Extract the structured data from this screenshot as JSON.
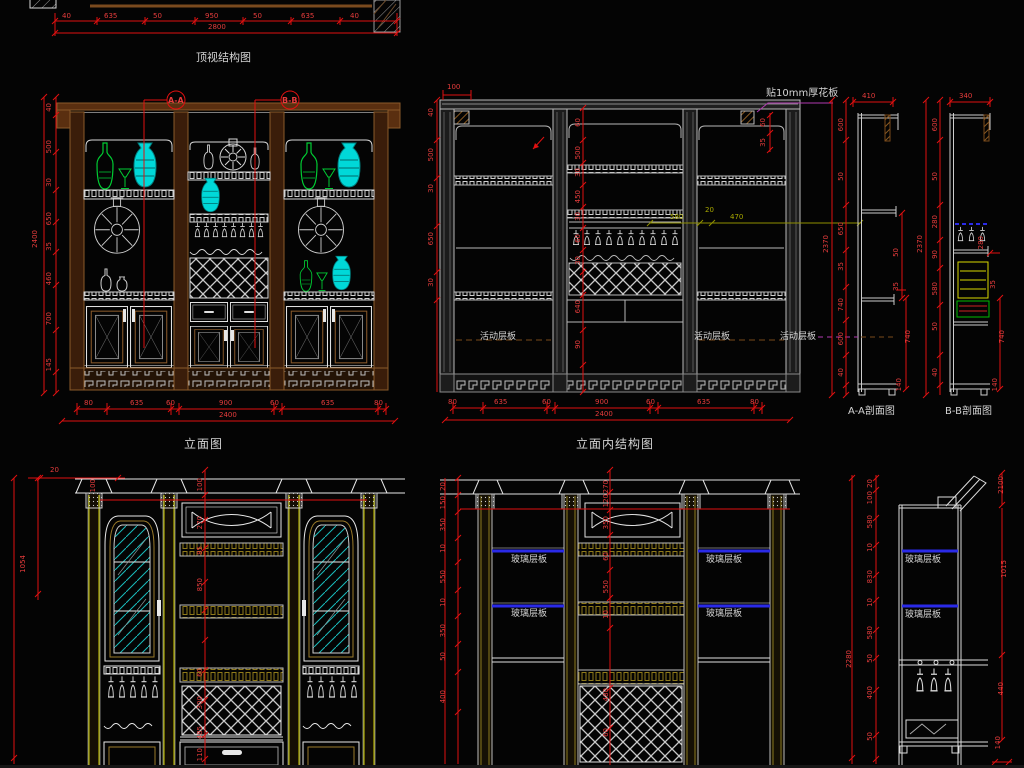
{
  "colors": {
    "background": "#040404",
    "dim_red": "#e01010",
    "line_white": "#d8d8d8",
    "line_grey": "#9a9a9a",
    "frame_brown": "#6a3a14",
    "item_green": "#00cc33",
    "item_cyan": "#00d8d8",
    "shelf_blue": "#2a2ae8",
    "accent_olive": "#8f8f00",
    "accent_yellow": "#cfcf00",
    "accent_magenta": "#b03ab0"
  },
  "titles": {
    "top_view": "顶视结构图",
    "elevation": "立面图",
    "internal_elevation": "立面内结构图",
    "section_a": "A-A剖面图",
    "section_b": "B-B剖面图"
  },
  "markers": {
    "a": "A-A",
    "b": "B-B"
  },
  "notes": {
    "board": "贴10mm厚花板",
    "movable_shelf": "活动层板",
    "glass_shelf": "玻璃层板"
  },
  "dims": {
    "top_chain": [
      "40",
      "635",
      "50",
      "950",
      "50",
      "635",
      "40"
    ],
    "top_total": [
      "2800"
    ],
    "elev_left": [
      "40",
      "500",
      "30",
      "650",
      "35",
      "460",
      "700",
      "145"
    ],
    "elev_left_total": [
      "2400"
    ],
    "elev_bottom": [
      "80",
      "635",
      "60",
      "900",
      "60",
      "635",
      "80"
    ],
    "elev_bottom_total": [
      "2400"
    ],
    "mid_left": [
      "40",
      "500",
      "30",
      "650",
      "30"
    ],
    "mid_top": [
      "100"
    ],
    "mid_right": [
      "60",
      "35"
    ],
    "mid_center": [
      "60",
      "500",
      "30",
      "450",
      "30",
      "60",
      "30",
      "640",
      "90"
    ],
    "mid_bottom": [
      "80",
      "635",
      "60",
      "900",
      "60",
      "635",
      "80"
    ],
    "mid_bottom_total": [
      "2400"
    ],
    "olive": [
      "580",
      "20",
      "470"
    ],
    "aa_left": [
      "600",
      "50",
      "650",
      "35",
      "740",
      "600",
      "40"
    ],
    "aa_total": [
      "2370"
    ],
    "aa_top": [
      "410"
    ],
    "aa_right": [
      "50",
      "35",
      "740",
      "140"
    ],
    "bb_left": [
      "600",
      "50",
      "280",
      "90",
      "580",
      "50",
      "40"
    ],
    "bb_total": [
      "2370"
    ],
    "bb_top": [
      "340"
    ],
    "bb_right": [
      "280",
      "35",
      "740",
      "140"
    ],
    "bl_top_a": [
      "20"
    ],
    "bl_top_b": [
      "100"
    ],
    "bl_left_total": [
      "1054"
    ],
    "bl_center": [
      "100",
      "270",
      "85",
      "850",
      "60",
      "300",
      "485",
      "110"
    ],
    "bm_left": [
      "20",
      "150",
      "350",
      "10",
      "550",
      "10",
      "350",
      "50",
      "400"
    ],
    "bm_center": [
      "270",
      "120",
      "350",
      "60",
      "550",
      "10",
      "480",
      "60"
    ],
    "standalone": [
      "20",
      "100",
      "580",
      "10",
      "830",
      "10",
      "580",
      "50",
      "400",
      "50"
    ],
    "standalone_total": [
      "2280"
    ],
    "br_right": [
      "2100",
      "1015",
      "440",
      "140"
    ]
  }
}
